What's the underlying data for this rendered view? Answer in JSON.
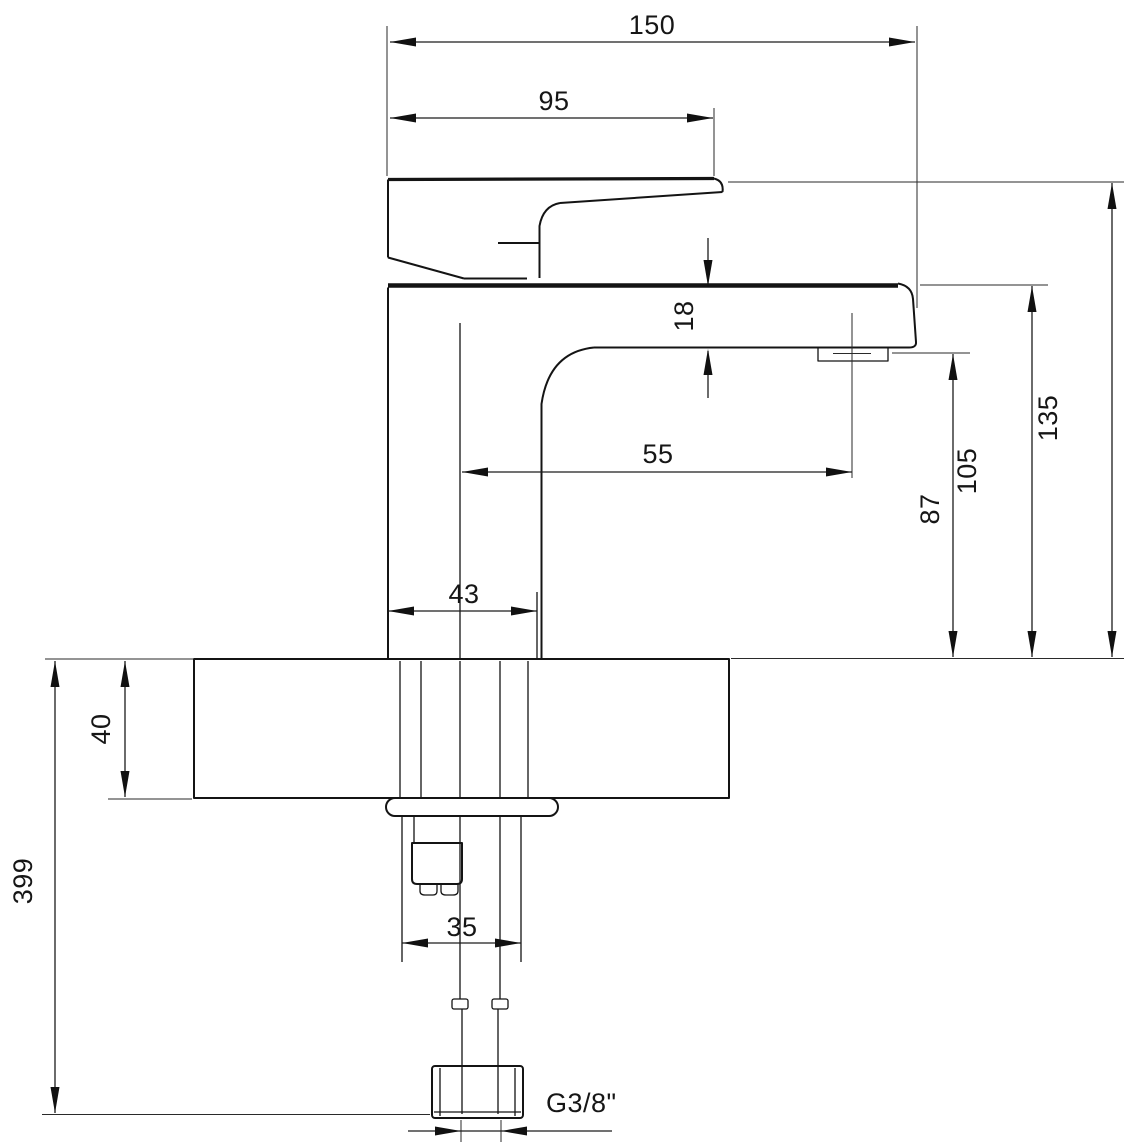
{
  "drawing": {
    "type": "faucet-technical-drawing",
    "background": "#ffffff",
    "line_color": "#141414",
    "dimensions": {
      "overall_length": "150",
      "handle_length": "95",
      "spout_end_height": "18",
      "aerator_offset": "55",
      "body_width": "43",
      "aerator_height": "87",
      "spout_top_height": "105",
      "overall_height": "135",
      "deck_thickness": "40",
      "overall_depth": "399",
      "shank_width": "35",
      "thread_size": "G3/8\""
    }
  }
}
